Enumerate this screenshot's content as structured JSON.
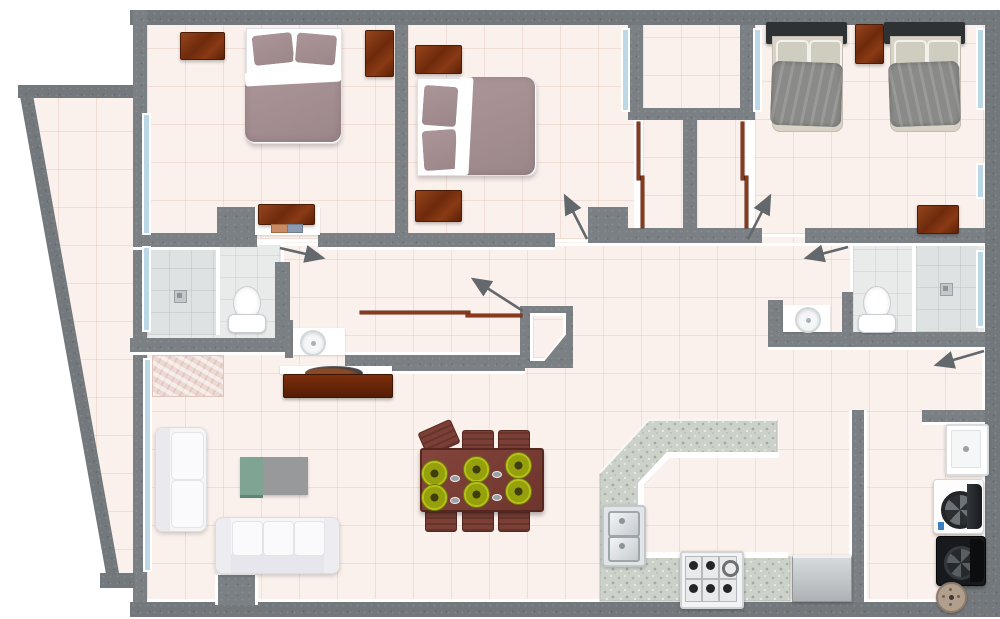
{
  "title": "apartment-floor-plan-top-view",
  "colors": {
    "wall_gray": "#7b8084",
    "outer_wall_gray": "#73787c",
    "floor_pink": "#fbf1ec",
    "bath_tile_gray": "#e9ebeb",
    "window_glass_blue": "#bcd7e6",
    "wood_brown": "#7a3414",
    "bed_duvet_mauve": "#a38e91",
    "twin_blanket_gray": "#8a8a88",
    "twin_headboard_dark": "#2e3235",
    "sofa_white": "#f5f5f7",
    "granite_counter": "#ccd2ca",
    "dining_wood_red": "#7b3f36",
    "plate_green": "#b5bd1d",
    "tv_table_teal": "#7fa493",
    "tv_table_gray": "#97999b",
    "door_arrow_gray": "#63686d",
    "sliding_door_brown": "#8a3a1c"
  },
  "rooms": [
    {
      "name": "bedroom-1",
      "position": "top-left",
      "furniture": [
        "double-bed-mauve",
        "dresser-top-left",
        "dresser-right-wall",
        "desk-alcove-with-papers"
      ],
      "windows": [
        "left-wall-window"
      ],
      "doors": [
        "swing-door-to-hallway"
      ]
    },
    {
      "name": "bedroom-2",
      "position": "top-middle",
      "furniture": [
        "double-bed-mauve-horizontal",
        "nightstand-upper",
        "nightstand-lower"
      ],
      "windows": [
        "shaft-window"
      ],
      "doors": [
        "swing-door-to-hallway",
        "sliding-closet"
      ]
    },
    {
      "name": "twin-bedroom",
      "position": "top-right",
      "furniture": [
        "twin-bed-left",
        "twin-bed-right",
        "nightstand-between-beds",
        "dresser-bottom-right"
      ],
      "windows": [
        "shaft-window",
        "right-wall-window-upper",
        "right-wall-window-lower"
      ],
      "doors": [
        "swing-door-to-hallway",
        "sliding-closet"
      ]
    },
    {
      "name": "light-shaft",
      "position": "top-center",
      "furniture": [],
      "windows": [
        "left",
        "right"
      ],
      "doors": []
    },
    {
      "name": "closet-left",
      "doors": [
        "sliding-brown-panels"
      ]
    },
    {
      "name": "closet-right",
      "doors": [
        "sliding-brown-panels"
      ]
    },
    {
      "name": "bathroom-left",
      "furniture": [
        "shower-with-drain",
        "toilet",
        "round-basin-vanity-niche"
      ],
      "windows": [
        "left-wall-window"
      ],
      "doors": [
        "swing-door-to-hallway"
      ]
    },
    {
      "name": "bathroom-right",
      "furniture": [
        "shower-with-drain",
        "toilet",
        "round-basin-vanity-niche"
      ],
      "windows": [
        "right-wall-window"
      ],
      "doors": [
        "swing-door-to-hallway"
      ]
    },
    {
      "name": "hallway",
      "furniture": [
        "sliding-door-closet"
      ],
      "doors": [
        "entry-door-niche"
      ]
    },
    {
      "name": "living-room",
      "furniture": [
        "area-rug",
        "loveseat-white",
        "sofa-white",
        "tv-table-teal-gray",
        "tv-console-with-bowl"
      ],
      "windows": [
        "balcony-glass-door"
      ]
    },
    {
      "name": "dining-area",
      "furniture": [
        "dining-table",
        "six-chairs",
        "six-green-place-settings"
      ]
    },
    {
      "name": "kitchen",
      "furniture": [
        "u-shaped-granite-counter",
        "double-sink",
        "gas-stove-6-burner",
        "stainless-appliance"
      ]
    },
    {
      "name": "laundry-service",
      "furniture": [
        "utility-sink",
        "washing-machine-open-door",
        "dryer-open-door",
        "round-basket"
      ]
    },
    {
      "name": "balcony",
      "position": "left-curved-wall",
      "furniture": []
    }
  ],
  "door_swings": [
    {
      "room": "bathroom-left",
      "from": [
        280,
        248
      ],
      "to": [
        326,
        258
      ]
    },
    {
      "room": "bedroom-2",
      "from": [
        587,
        239
      ],
      "to": [
        563,
        193
      ]
    },
    {
      "room": "twin-bedroom",
      "from": [
        748,
        239
      ],
      "to": [
        772,
        193
      ]
    },
    {
      "room": "bathroom-right",
      "from": [
        848,
        247
      ],
      "to": [
        803,
        258
      ]
    },
    {
      "room": "laundry-service",
      "from": [
        984,
        351
      ],
      "to": [
        933,
        366
      ]
    },
    {
      "room": "entry",
      "from": [
        523,
        311
      ],
      "to": [
        470,
        277
      ]
    }
  ]
}
